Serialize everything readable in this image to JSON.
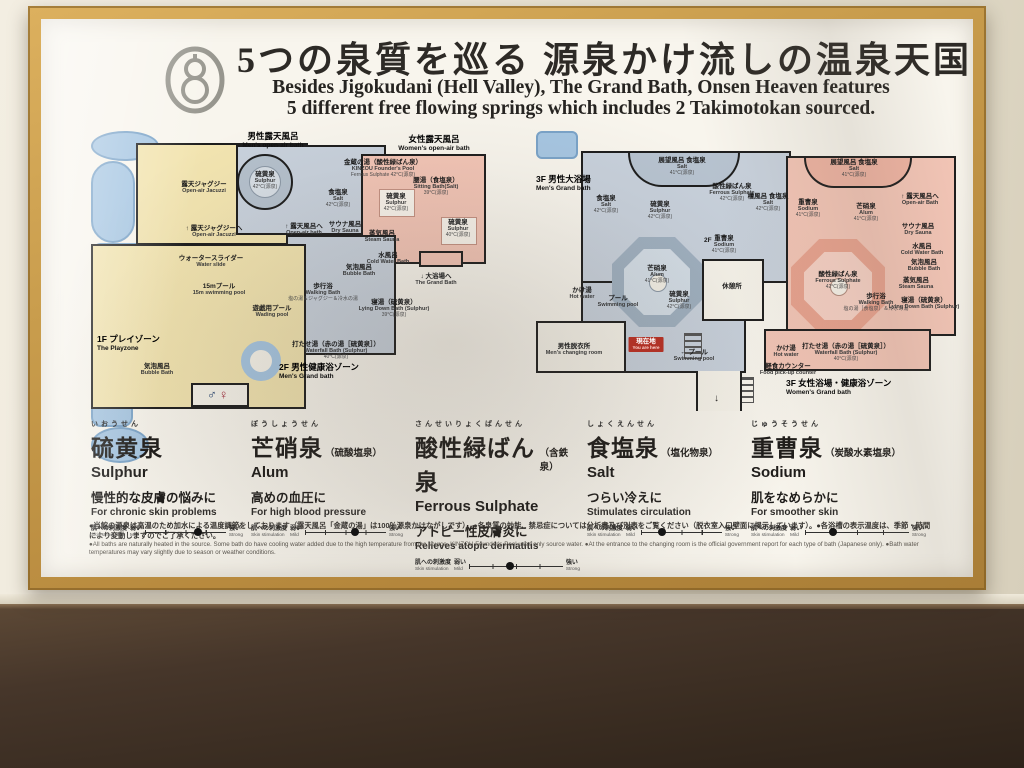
{
  "colors": {
    "frame_wood": "#c89c4c",
    "wall": "#eae4d4",
    "shelf_wood": "#46362a",
    "playzone_yellow": "#f2e4b0",
    "bath_blue_grey": "#c8d1dc",
    "womens_pink": "#f3c5b6",
    "pool_blue": "#a6c6e2",
    "you_are_here_red": "#b03226"
  },
  "header": {
    "logo_name": "takimotokan-gourd-logo",
    "title_jp": "5つの泉質を巡る 源泉かけ流しの温泉天国",
    "subtitle_en_line1": "Besides Jigokudani (Hell Valley), The Grand Bath, Onsen Heaven features",
    "subtitle_en_line2": "5 different free flowing springs which includes 2 Takimotokan sourced."
  },
  "maps": {
    "left": {
      "restroom_male": "♂",
      "restroom_female": "♀",
      "labels": [
        {
          "jp": "男性露天風呂",
          "en": "Men's open-air bath",
          "temp": ""
        },
        {
          "jp": "金蔵の湯（酸性緑ばん泉）",
          "en": "KINZOU Founder's Pool",
          "temp": "Ferrous Sulphate 42°C(源泉)"
        },
        {
          "jp": "女性露天風呂",
          "en": "Women's open-air bath",
          "temp": ""
        },
        {
          "jp": "露天ジャグジー",
          "en": "Open-air Jacuzzi",
          "temp": ""
        },
        {
          "jp": "硫黄泉",
          "en": "Sulphur",
          "temp": "42°C(源泉)"
        },
        {
          "jp": "食塩泉",
          "en": "Salt",
          "temp": "42°C(源泉)"
        },
        {
          "jp": "腰湯（食塩泉）",
          "en": "Sitting Bath(Salt)",
          "temp": "39°C(源泉)"
        },
        {
          "jp": "硫黄泉",
          "en": "Sulphur",
          "temp": "42°C(源泉)"
        },
        {
          "jp": "硫黄泉",
          "en": "Sulphur",
          "temp": "40°C(源泉)"
        },
        {
          "jp": "↑ 露天ジャグジーへ",
          "en": "Open-air Jacuzzi",
          "temp": ""
        },
        {
          "jp": "↑ 露天風呂へ",
          "en": "Open-air bath",
          "temp": ""
        },
        {
          "jp": "サウナ風呂",
          "en": "Dry Sauna",
          "temp": ""
        },
        {
          "jp": "蒸気風呂",
          "en": "Steam Sauna",
          "temp": ""
        },
        {
          "jp": "水風呂",
          "en": "Cold Water Bath",
          "temp": ""
        },
        {
          "jp": "気泡風呂",
          "en": "Bubble Bath",
          "temp": ""
        },
        {
          "jp": "歩行浴",
          "en": "Walking Bath",
          "temp": "塩の湯＆ジャグジー＆冷水の湯"
        },
        {
          "jp": "寝湯（硫黄泉）",
          "en": "Lying Down Bath (Sulphur)",
          "temp": "39°C(源泉)"
        },
        {
          "jp": "打たせ湯（赤の湯［硫黄泉］）",
          "en": "Waterfall Bath (Sulphur)",
          "temp": "40°C(源泉)"
        },
        {
          "jp": "1F プレイゾーン",
          "en": "The Playzone",
          "temp": ""
        },
        {
          "jp": "15mプール",
          "en": "15m swimming pool",
          "temp": ""
        },
        {
          "jp": "遊戯用プール",
          "en": "Wading pool",
          "temp": ""
        },
        {
          "jp": "ウォータースライダー",
          "en": "Water slide",
          "temp": ""
        },
        {
          "jp": "気泡風呂",
          "en": "Bubble Bath",
          "temp": ""
        },
        {
          "jp": "2F 男性健康浴ゾーン",
          "en": "Men's Grand bath",
          "temp": ""
        },
        {
          "jp": "↓ 大浴場へ",
          "en": "The Grand Bath",
          "temp": ""
        }
      ]
    },
    "right": {
      "labels": [
        {
          "jp": "3F 男性大浴場",
          "en": "Men's Grand bath",
          "temp": ""
        },
        {
          "jp": "展望風呂 食塩泉",
          "en": "Salt",
          "temp": "41°C(源泉)"
        },
        {
          "jp": "酸性緑ばん泉",
          "en": "Ferrous Sulphate",
          "temp": "42°C(源泉)"
        },
        {
          "jp": "食塩泉",
          "en": "Salt",
          "temp": "42°C(源泉)"
        },
        {
          "jp": "硫黄泉",
          "en": "Sulphur",
          "temp": "42°C(源泉)"
        },
        {
          "jp": "檜風呂 食塩泉",
          "en": "Salt",
          "temp": "42°C(源泉)"
        },
        {
          "jp": "展望風呂 食塩泉",
          "en": "Salt",
          "temp": "41°C(源泉)"
        },
        {
          "jp": "重曹泉",
          "en": "Sodium",
          "temp": "41°C(源泉)"
        },
        {
          "jp": "芒硝泉",
          "en": "Alum",
          "temp": "41°C(源泉)"
        },
        {
          "jp": "↑ 露天風呂へ",
          "en": "Open-air Bath",
          "temp": ""
        },
        {
          "jp": "サウナ風呂",
          "en": "Dry Sauna",
          "temp": ""
        },
        {
          "jp": "水風呂",
          "en": "Cold Water Bath",
          "temp": ""
        },
        {
          "jp": "気泡風呂",
          "en": "Bubble Bath",
          "temp": ""
        },
        {
          "jp": "蒸気風呂",
          "en": "Steam Sauna",
          "temp": ""
        },
        {
          "jp": "寝湯（硫黄泉）",
          "en": "Lying Down Bath (Sulphur)",
          "temp": ""
        },
        {
          "jp": "芒硝泉",
          "en": "Alum",
          "temp": "41°C(源泉)"
        },
        {
          "jp": "重曹泉",
          "en": "Sodium",
          "temp": "41°C(源泉)"
        },
        {
          "jp": "硫黄泉",
          "en": "Sulphur",
          "temp": "42°C(源泉)"
        },
        {
          "jp": "酸性緑ばん泉",
          "en": "Ferrous Sulphate",
          "temp": "42°C(源泉)"
        },
        {
          "jp": "歩行浴",
          "en": "Walking Bath",
          "temp": "塩の湯［食塩泉］＆冷水の湯"
        },
        {
          "jp": "打たせ湯（赤の湯［硫黄泉］）",
          "en": "Waterfall Bath (Sulphur)",
          "temp": "40°C(源泉)"
        },
        {
          "jp": "かけ湯",
          "en": "Hot water",
          "temp": ""
        },
        {
          "jp": "かけ湯",
          "en": "Hot water",
          "temp": ""
        },
        {
          "jp": "プール",
          "en": "Swimming pool",
          "temp": ""
        },
        {
          "jp": "男性脱衣所",
          "en": "Men's changing room",
          "temp": ""
        },
        {
          "jp": "現在地",
          "en": "You are here",
          "temp": ""
        },
        {
          "jp": "← プール",
          "en": "Swimming pool",
          "temp": ""
        },
        {
          "jp": "軽食カウンター",
          "en": "Food pick-up counter",
          "temp": ""
        },
        {
          "jp": "休憩所",
          "en": "",
          "temp": ""
        },
        {
          "jp": "2F →",
          "en": "",
          "temp": ""
        },
        {
          "jp": "3F 女性浴場・健康浴ゾーン",
          "en": "Women's Grand bath",
          "temp": ""
        }
      ]
    }
  },
  "scale": {
    "label_jp": "肌への刺激度",
    "label_en": "Skin stimulation",
    "mild_jp": "弱い",
    "mild_en": "Mild",
    "strong_jp": "強い",
    "strong_en": "Strong"
  },
  "springs": [
    {
      "furigana": "いおうせん",
      "name_jp": "硫黄泉",
      "name_suffix": "",
      "name_en": "Sulphur",
      "benefit_jp": "慢性的な皮膚の悩みに",
      "benefit_en": "For chronic skin problems",
      "dot_style": "left:66%"
    },
    {
      "furigana": "ぼうしょうせん",
      "name_jp": "芒硝泉",
      "name_suffix": "（硫酸塩泉）",
      "name_en": "Alum",
      "benefit_jp": "高めの血圧に",
      "benefit_en": "For high blood pressure",
      "dot_style": "left:62%"
    },
    {
      "furigana": "さんせいりょくばんせん",
      "name_jp": "酸性緑ばん泉",
      "name_suffix": "（含鉄泉）",
      "name_en": "Ferrous Sulphate",
      "benefit_jp": "アトピー性皮膚炎に",
      "benefit_en": "Relieves atopic dermatitis",
      "dot_style": "left:44%"
    },
    {
      "furigana": "しょくえんせん",
      "name_jp": "食塩泉",
      "name_suffix": "（塩化物泉）",
      "name_en": "Salt",
      "benefit_jp": "つらい冷えに",
      "benefit_en": "Stimulates circulation",
      "dot_style": "left:26%"
    },
    {
      "furigana": "じゅうそうせん",
      "name_jp": "重曹泉",
      "name_suffix": "（炭酸水素塩泉）",
      "name_en": "Sodium",
      "benefit_jp": "肌をなめらかに",
      "benefit_en": "For smoother skin",
      "dot_style": "left:27%"
    }
  ],
  "footnotes": {
    "jp": "●当館の源泉は高温のため加水による温度調節をしております（露天風呂「金蔵の湯」は100％源泉かけながしです）。●各泉質の効能、禁忌症については分析書及び別表をご覧ください（脱衣室入口壁面に掲示しています）。●各浴槽の表示温度は、季節・時間により変動しますのでご了承ください。",
    "en": "●All baths are naturally heated in the source. Some bath do have cooling water added due to the high temperature from the source. KINZOU Founder's Pool uses only source water. ●At the entrance to the changing room is the official government report for each type of bath (Japanese only). ●Bath water temperatures may vary slightly due to season or weather conditions."
  }
}
